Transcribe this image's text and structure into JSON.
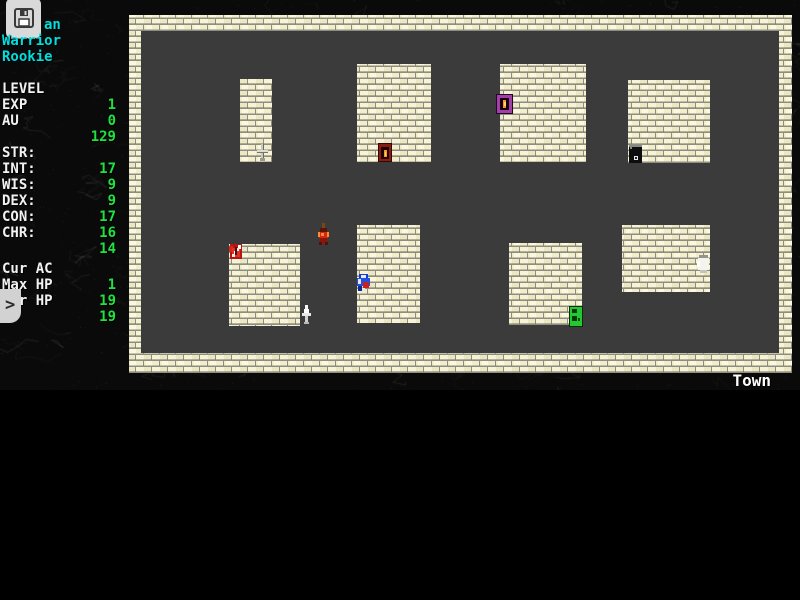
{
  "status": {
    "location": "Town"
  },
  "sidebar": {
    "character": {
      "name_visible": "an",
      "class": "Warrior",
      "rank": "Rookie"
    },
    "progress": [
      {
        "label": "LEVEL",
        "value": "1"
      },
      {
        "label": "EXP",
        "value": "0"
      },
      {
        "label": "AU",
        "value": "129"
      }
    ],
    "attributes": [
      {
        "label": "STR:",
        "value": "17"
      },
      {
        "label": "INT:",
        "value": "9"
      },
      {
        "label": "WIS:",
        "value": "9"
      },
      {
        "label": "DEX:",
        "value": "17"
      },
      {
        "label": "CON:",
        "value": "16"
      },
      {
        "label": "CHR:",
        "value": "14"
      }
    ],
    "vitals": [
      {
        "label": "Cur AC",
        "value": "1"
      },
      {
        "label": "Max HP",
        "value": "19"
      },
      {
        "label": "Cur HP",
        "value": "19"
      }
    ],
    "prompt": ">",
    "save_icon": "floppy-disk-icon"
  },
  "colors": {
    "value_green": "#20e23e",
    "class_cyan": "#00dede",
    "label_white": "#f2f2f2",
    "brick_cream": "#f2eeca",
    "mortar_gray": "#8f8d82",
    "floor_gray": "#3b3b3b",
    "rock_black": "#0a0a0a"
  },
  "map": {
    "label": "Town",
    "frame": {
      "interior": {
        "x": 141,
        "y": 31,
        "w": 638,
        "h": 322
      },
      "walls": [
        {
          "x": 129,
          "y": 15,
          "w": 663,
          "h": 16
        },
        {
          "x": 129,
          "y": 15,
          "w": 12,
          "h": 358
        },
        {
          "x": 779,
          "y": 15,
          "w": 13,
          "h": 358
        },
        {
          "x": 129,
          "y": 353,
          "w": 663,
          "h": 20
        }
      ]
    },
    "buildings": [
      {
        "x": 240,
        "y": 79,
        "w": 32,
        "h": 83
      },
      {
        "x": 357,
        "y": 64,
        "w": 74,
        "h": 98
      },
      {
        "x": 500,
        "y": 64,
        "w": 86,
        "h": 98
      },
      {
        "x": 628,
        "y": 80,
        "w": 82,
        "h": 83
      },
      {
        "x": 229,
        "y": 244,
        "w": 71,
        "h": 82
      },
      {
        "x": 357,
        "y": 225,
        "w": 63,
        "h": 98
      },
      {
        "x": 509,
        "y": 243,
        "w": 73,
        "h": 82
      },
      {
        "x": 622,
        "y": 225,
        "w": 88,
        "h": 67
      }
    ],
    "sprites": [
      {
        "type": "sword-gray",
        "x": 255,
        "y": 144
      },
      {
        "type": "door-red",
        "x": 378,
        "y": 143
      },
      {
        "type": "door-purple",
        "x": 496,
        "y": 94
      },
      {
        "type": "door-black",
        "x": 629,
        "y": 145
      },
      {
        "type": "shield-red",
        "x": 228,
        "y": 243
      },
      {
        "type": "dagger-white",
        "x": 300,
        "y": 305
      },
      {
        "type": "guard-blue",
        "x": 356,
        "y": 274
      },
      {
        "type": "door-green",
        "x": 569,
        "y": 306
      },
      {
        "type": "blob-white",
        "x": 696,
        "y": 255
      },
      {
        "type": "char-red",
        "x": 317,
        "y": 223
      }
    ]
  }
}
